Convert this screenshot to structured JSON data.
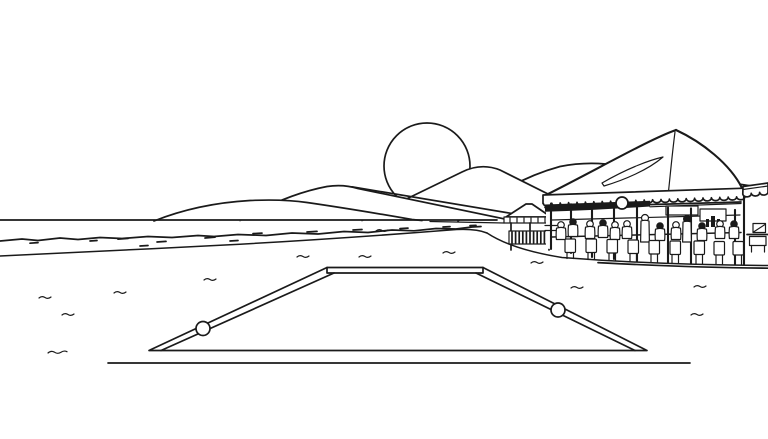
{
  "meta": {
    "title": "Black-and-white line drawing of a beach scene",
    "description": "Outline illustration of a seaside beach: distant overlapping hills with a setting sun, a calm sea with a surf line on the left, a wide sand beach with small wave marks, a sunken rectangular pool or ramp with side rails and two rail balls in the foreground, a small gazebo with a slatted counter, and a busy open-air beach bar under a peaked canopy tent full of seated patrons."
  },
  "colors": {
    "ink": "#1a1a1a",
    "background": "#ffffff"
  },
  "scene": {
    "sky": {
      "label": "empty sky"
    },
    "sun": {
      "label": "sun half-hidden behind the hills"
    },
    "hills": {
      "label": "overlapping hill ridges",
      "count": 4
    },
    "sea": {
      "label": "sea with irregular surf/foam line",
      "horizon_side": "left"
    },
    "beach": {
      "label": "sand beach",
      "wave_mark_count": 13
    },
    "pool_ramp": {
      "label": "sunken pool / boat ramp seen in perspective",
      "rails": 2,
      "rail_balls": 2
    },
    "gazebo": {
      "label": "small beach gazebo with dark slatted counter"
    },
    "beach_bar": {
      "label": "canopy-tent beach bar",
      "details": [
        "tall peaked canvas roof with fold",
        "scalloped valance with shadow band",
        "hanging round lantern",
        "menu boards on back wall",
        "bar counter with bottles",
        "row of high-back chairs",
        "side stand with signed card",
        "second scalloped awning at right edge"
      ],
      "seated_patrons": 11,
      "bartenders": 2,
      "chairs": 9
    }
  }
}
